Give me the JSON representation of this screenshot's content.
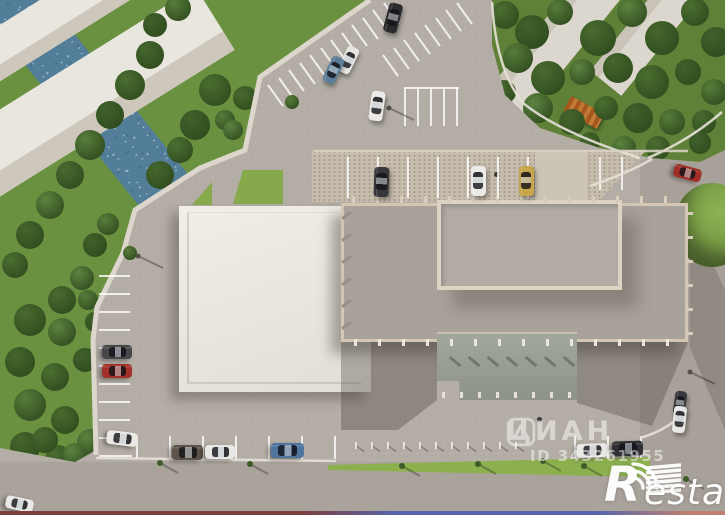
{
  "watermarks": {
    "cian": {
      "icon": "cian-compass-logo-icon",
      "text": "ЦИАН",
      "id_text": "ID 343261955"
    },
    "restate": {
      "icon": "signal-arcs-icon",
      "r": "R",
      "rest": "estate"
    }
  },
  "scene": {
    "colors": {
      "asphalt": "#b3ada5",
      "road": "#a8a19a",
      "river": "#527e9a",
      "white_roof": "#eceae4",
      "gray_roof": "#a8a29b",
      "parapet": "#d3c7b4",
      "grass_bright": "#86a94c",
      "grass_dark": "#5e8037",
      "pebble": "#c6bdae",
      "wall": "#dcd6cc",
      "marking": "#ffffff"
    },
    "cars": [
      [
        393,
        18,
        15,
        30,
        14,
        "#2b2b2e"
      ],
      [
        348,
        60,
        26,
        28,
        13,
        "#e7e5e1"
      ],
      [
        333,
        70,
        26,
        28,
        13,
        "#5b7c97"
      ],
      [
        377,
        106,
        8,
        30,
        14,
        "#eceae6"
      ],
      [
        381,
        182,
        2,
        30,
        15,
        "#37373a"
      ],
      [
        478,
        181,
        0,
        30,
        15,
        "#edebe7"
      ],
      [
        526,
        181,
        0,
        30,
        15,
        "#c9a54b"
      ],
      [
        687,
        173,
        105,
        28,
        13,
        "#a02d26"
      ],
      [
        117,
        352,
        90,
        30,
        14,
        "#47474a"
      ],
      [
        117,
        371,
        90,
        30,
        14,
        "#a33029"
      ],
      [
        122,
        438,
        97,
        31,
        14,
        "#eae8e4"
      ],
      [
        187,
        452,
        90,
        31,
        15,
        "#5d5349"
      ],
      [
        220,
        452,
        90,
        30,
        14,
        "#e9e7e3"
      ],
      [
        287,
        450,
        90,
        33,
        15,
        "#4f759e"
      ],
      [
        592,
        450,
        88,
        31,
        14,
        "#eae8e4"
      ],
      [
        627,
        448,
        88,
        31,
        15,
        "#303034"
      ],
      [
        680,
        403,
        8,
        24,
        12,
        "#3a3a3e"
      ],
      [
        679,
        419,
        6,
        27,
        13,
        "#e9e7e3"
      ],
      [
        19,
        504,
        102,
        28,
        13,
        "#eae8e4"
      ]
    ],
    "trees_left": [
      [
        215,
        90,
        16
      ],
      [
        195,
        125,
        15
      ],
      [
        225,
        120,
        10
      ],
      [
        245,
        98,
        12
      ],
      [
        233,
        130,
        10
      ],
      [
        160,
        175,
        14
      ],
      [
        180,
        150,
        13
      ],
      [
        95,
        245,
        12
      ],
      [
        108,
        224,
        11
      ],
      [
        62,
        300,
        14
      ],
      [
        82,
        278,
        12
      ],
      [
        150,
        55,
        14
      ],
      [
        130,
        85,
        15
      ],
      [
        110,
        115,
        14
      ],
      [
        90,
        145,
        15
      ],
      [
        70,
        175,
        14
      ],
      [
        50,
        205,
        14
      ],
      [
        30,
        235,
        14
      ],
      [
        15,
        265,
        13
      ],
      [
        155,
        25,
        12
      ],
      [
        178,
        8,
        13
      ],
      [
        30,
        320,
        16
      ],
      [
        62,
        332,
        14
      ],
      [
        20,
        362,
        15
      ],
      [
        55,
        377,
        14
      ],
      [
        85,
        360,
        12
      ],
      [
        30,
        405,
        16
      ],
      [
        65,
        420,
        14
      ],
      [
        90,
        442,
        13
      ],
      [
        25,
        447,
        15
      ],
      [
        58,
        457,
        12
      ],
      [
        95,
        322,
        10
      ],
      [
        88,
        300,
        10
      ],
      [
        45,
        440,
        13
      ],
      [
        75,
        455,
        12
      ]
    ],
    "trees_tr": [
      [
        505,
        15,
        14
      ],
      [
        532,
        32,
        17
      ],
      [
        560,
        12,
        13
      ],
      [
        598,
        38,
        18
      ],
      [
        632,
        12,
        15
      ],
      [
        662,
        38,
        17
      ],
      [
        695,
        12,
        14
      ],
      [
        716,
        42,
        15
      ],
      [
        518,
        58,
        15
      ],
      [
        548,
        78,
        17
      ],
      [
        582,
        72,
        13
      ],
      [
        618,
        68,
        15
      ],
      [
        652,
        82,
        17
      ],
      [
        688,
        72,
        13
      ],
      [
        714,
        92,
        13
      ],
      [
        504,
        92,
        12
      ],
      [
        538,
        108,
        15
      ],
      [
        572,
        122,
        13
      ],
      [
        606,
        108,
        12
      ],
      [
        638,
        118,
        15
      ],
      [
        672,
        122,
        13
      ],
      [
        704,
        122,
        12
      ],
      [
        624,
        148,
        12
      ],
      [
        590,
        142,
        10
      ],
      [
        658,
        148,
        12
      ],
      [
        700,
        143,
        11
      ]
    ],
    "bushes": [
      [
        292,
        102,
        7
      ],
      [
        130,
        253,
        7
      ]
    ],
    "persons": [
      [
        537,
        417
      ],
      [
        494,
        172
      ]
    ],
    "wall_points": "370,0 260,77 245,150 200,168 135,210 123,253 97,307 93,340 96,455",
    "parking_lines": [
      [
        268,
        85,
        283,
        106
      ],
      [
        279,
        78,
        294,
        99
      ],
      [
        289,
        70,
        304,
        91
      ],
      [
        300,
        63,
        315,
        84
      ],
      [
        310,
        55,
        325,
        76
      ],
      [
        321,
        48,
        336,
        69
      ],
      [
        331,
        40,
        346,
        61
      ],
      [
        342,
        33,
        357,
        54
      ],
      [
        352,
        25,
        367,
        46
      ],
      [
        363,
        18,
        378,
        39
      ],
      [
        373,
        10,
        388,
        31
      ],
      [
        384,
        3,
        399,
        24
      ],
      [
        383,
        55,
        398,
        76
      ],
      [
        394,
        48,
        409,
        69
      ],
      [
        404,
        40,
        419,
        61
      ],
      [
        415,
        33,
        430,
        54
      ],
      [
        425,
        25,
        440,
        46
      ],
      [
        436,
        18,
        451,
        39
      ],
      [
        446,
        10,
        461,
        31
      ],
      [
        457,
        3,
        472,
        24
      ],
      [
        404,
        88,
        459,
        88
      ],
      [
        405,
        88,
        405,
        126
      ],
      [
        418,
        88,
        418,
        126
      ],
      [
        431,
        88,
        431,
        126
      ],
      [
        444,
        88,
        444,
        126
      ],
      [
        457,
        88,
        457,
        126
      ],
      [
        99,
        276,
        130,
        276
      ],
      [
        99,
        294,
        130,
        294
      ],
      [
        99,
        312,
        130,
        312
      ],
      [
        99,
        330,
        130,
        330
      ],
      [
        99,
        348,
        130,
        348
      ],
      [
        99,
        366,
        130,
        366
      ],
      [
        99,
        384,
        130,
        384
      ],
      [
        99,
        402,
        130,
        402
      ],
      [
        99,
        420,
        130,
        420
      ],
      [
        99,
        438,
        130,
        438
      ],
      [
        99,
        456,
        132,
        456
      ],
      [
        137,
        436,
        137,
        459
      ],
      [
        170,
        436,
        170,
        459
      ],
      [
        203,
        436,
        203,
        459
      ],
      [
        236,
        436,
        236,
        459
      ],
      [
        269,
        436,
        269,
        459
      ],
      [
        302,
        436,
        302,
        459
      ],
      [
        335,
        436,
        335,
        459
      ],
      [
        575,
        436,
        575,
        458
      ],
      [
        608,
        436,
        608,
        458
      ],
      [
        641,
        436,
        641,
        458
      ],
      [
        348,
        157,
        348,
        198
      ],
      [
        378,
        157,
        378,
        198
      ],
      [
        408,
        157,
        408,
        198
      ],
      [
        438,
        157,
        438,
        198
      ],
      [
        468,
        157,
        468,
        198
      ],
      [
        498,
        157,
        498,
        198
      ],
      [
        528,
        157,
        528,
        198
      ],
      [
        600,
        157,
        600,
        190
      ],
      [
        622,
        157,
        622,
        190
      ]
    ],
    "crosswalk": [
      [
        646,
        468,
        681,
        465
      ],
      [
        646,
        473,
        681,
        470
      ],
      [
        646,
        478,
        681,
        475
      ],
      [
        646,
        483,
        681,
        480
      ],
      [
        646,
        488,
        681,
        485
      ],
      [
        646,
        493,
        681,
        490
      ]
    ],
    "curves": [
      "M648,158 Q690,140 722,112",
      "M590,186 Q630,172 652,159",
      "M640,438 Q668,430 684,412",
      "M96,458 L336,461",
      "M492,2 Q496,70 523,103 Q560,133 640,158"
    ],
    "strip_edge": "M314,151 L688,151",
    "lamps": [
      [
        389,
        108
      ],
      [
        138,
        256
      ],
      [
        690,
        372
      ]
    ],
    "saplings": [
      [
        160,
        463
      ],
      [
        250,
        464
      ],
      [
        402,
        466
      ],
      [
        478,
        464
      ],
      [
        543,
        461
      ],
      [
        584,
        466
      ],
      [
        686,
        479
      ]
    ],
    "detail_runs": [
      {
        "x0": 352,
        "y0": 196,
        "dx": 24,
        "dy": 0,
        "n": 14,
        "w": 3,
        "h": 7,
        "rot": 0,
        "c": "#d8cdbb",
        "name": "parapet-post"
      },
      {
        "x0": 354,
        "y0": 339,
        "dx": 24,
        "dy": 0,
        "n": 14,
        "w": 3,
        "h": 7,
        "rot": 0,
        "c": "#ece6da",
        "name": "facade-column"
      },
      {
        "x0": 686,
        "y0": 212,
        "dx": 0,
        "dy": 24,
        "n": 6,
        "w": 7,
        "h": 3,
        "rot": 0,
        "c": "#d8cdbb",
        "name": "roof-beam"
      },
      {
        "x0": 341,
        "y0": 214,
        "dx": 0,
        "dy": 22,
        "n": 6,
        "w": 11,
        "h": 3,
        "rot": -36,
        "c": "#95908a",
        "name": "pergola-beam"
      },
      {
        "x0": 442,
        "y0": 392,
        "dx": 18,
        "dy": 0,
        "n": 8,
        "w": 3,
        "h": 6,
        "rot": 0,
        "c": "#e8e2d6",
        "name": "canopy-post"
      },
      {
        "x0": 448,
        "y0": 360,
        "dx": 19,
        "dy": 0,
        "n": 7,
        "w": 14,
        "h": 3,
        "rot": 40,
        "c": "rgba(0,0,0,0.25)",
        "name": "canopy-post-shadow"
      },
      {
        "x0": 355,
        "y0": 442,
        "dx": 16,
        "dy": 0,
        "n": 11,
        "w": 2,
        "h": 7,
        "rot": 0,
        "c": "#eae4d8",
        "name": "fence-post"
      },
      {
        "x0": 356,
        "y0": 448,
        "dx": 16,
        "dy": 0,
        "n": 11,
        "w": 9,
        "h": 2,
        "rot": 35,
        "c": "rgba(0,0,0,0.2)",
        "name": "fence-post-shadow"
      }
    ],
    "tree_palette": [
      "#4a6f30",
      "#3f612a",
      "#567d3a",
      "#486b2e",
      "#5c8440",
      "#44672c"
    ]
  }
}
